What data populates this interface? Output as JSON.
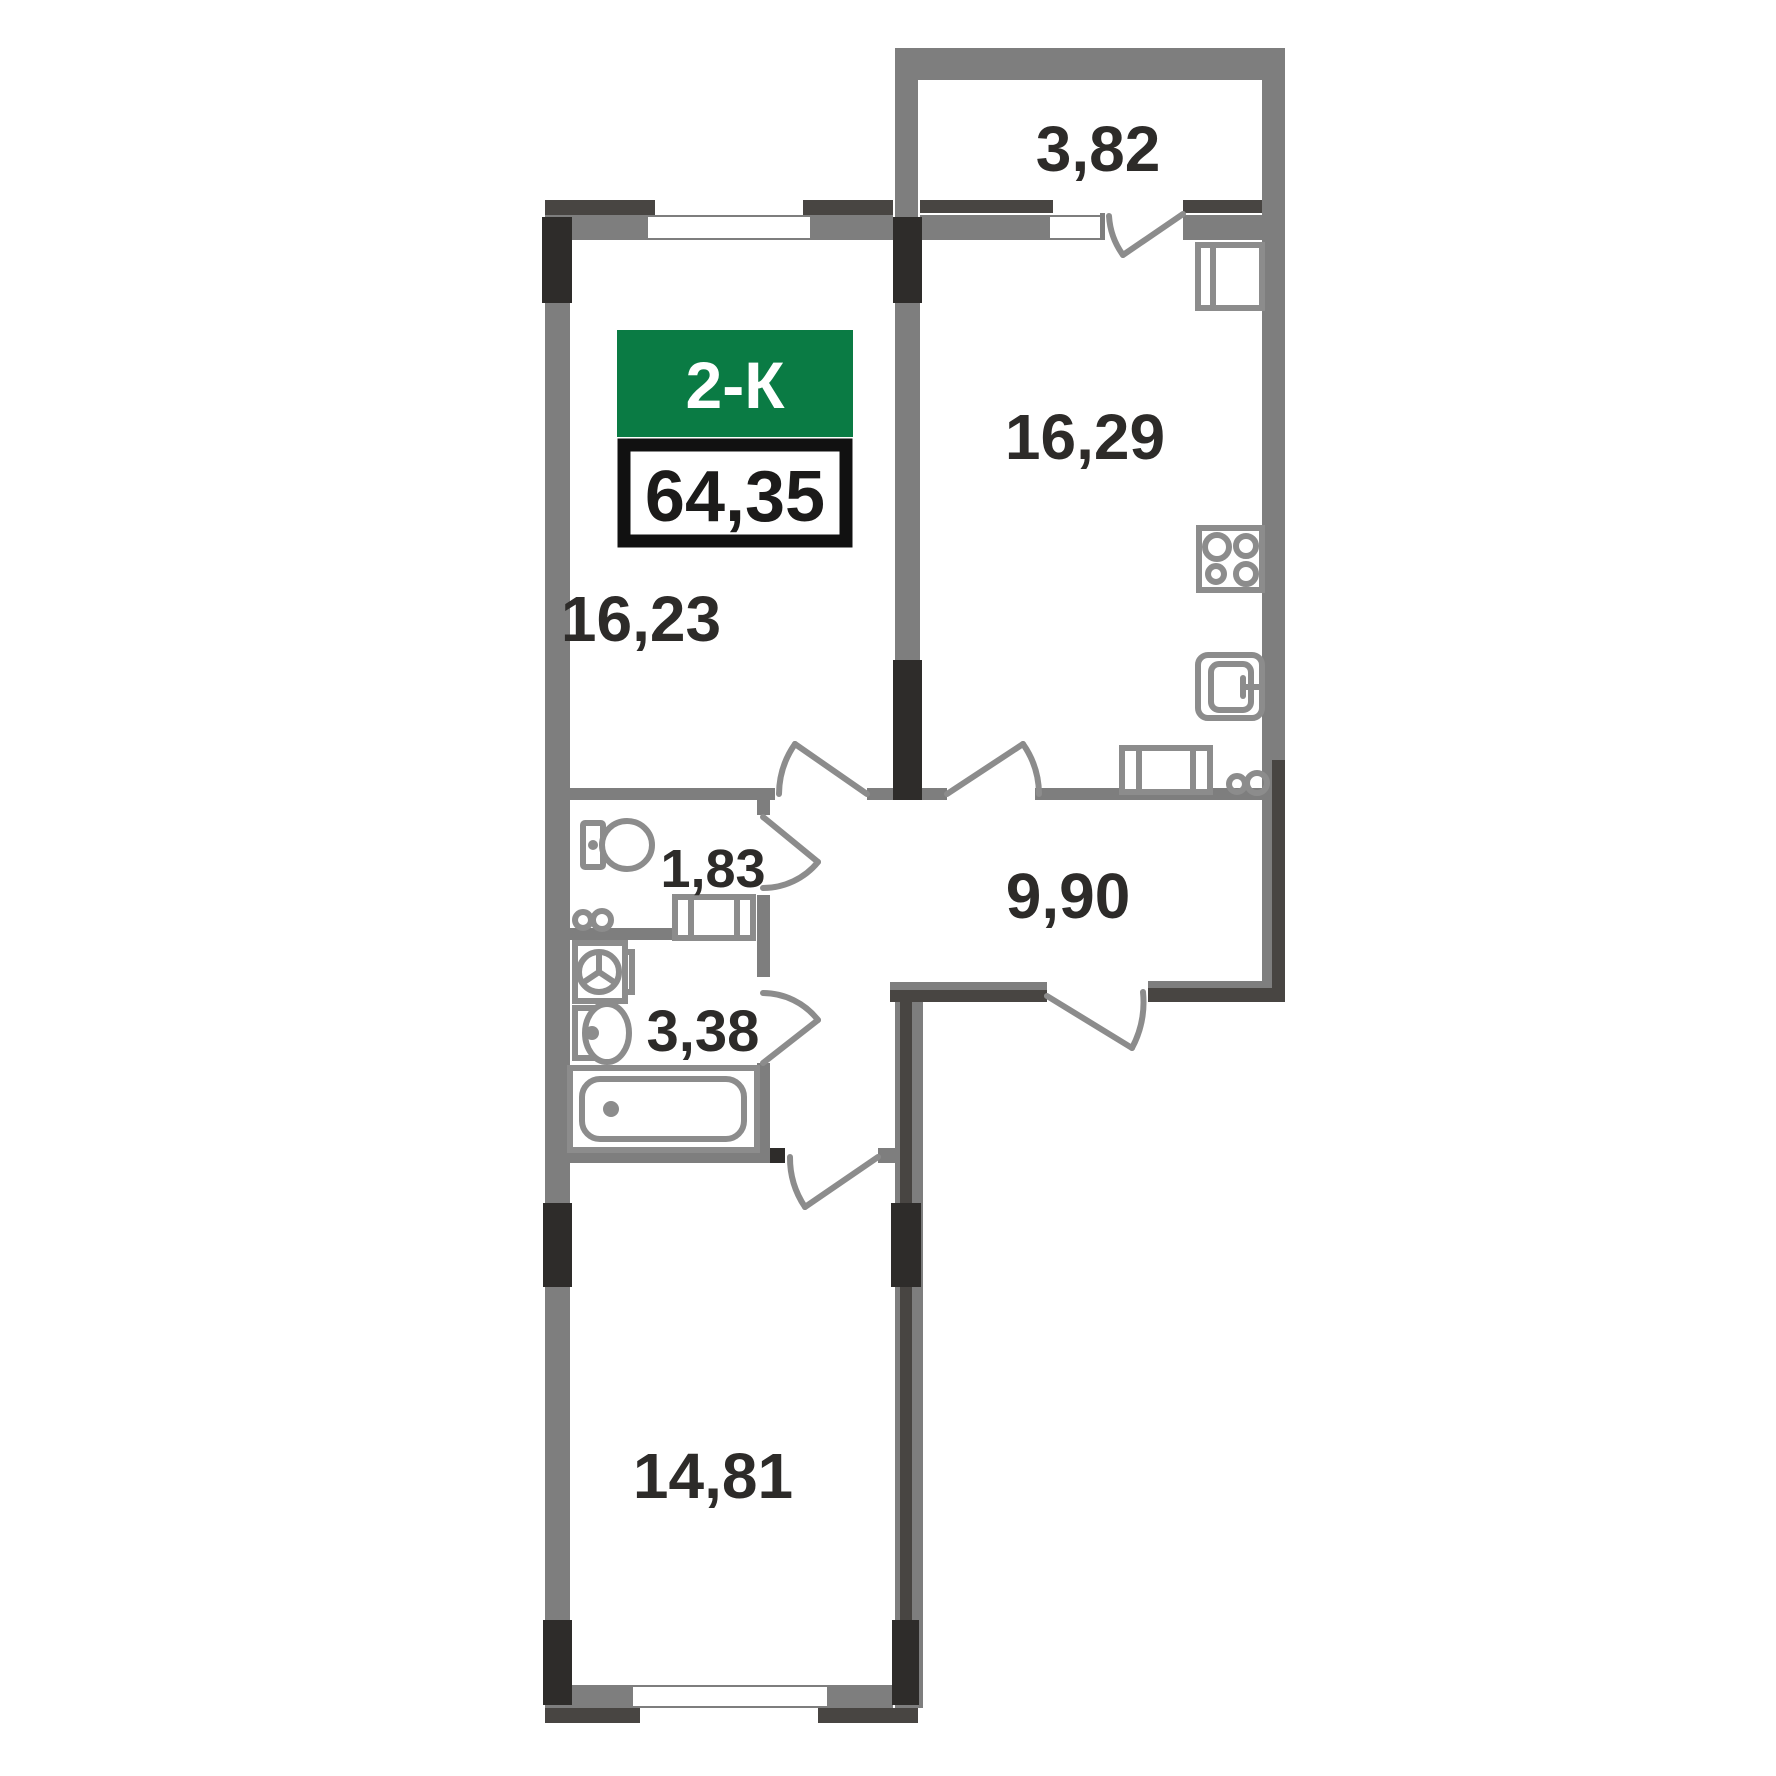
{
  "badge": {
    "type_label": "2-К",
    "total_area_label": "64,35"
  },
  "rooms": {
    "balcony": "3,82",
    "kitchen": "16,29",
    "living_room": "16,23",
    "wc": "1,83",
    "hallway": "9,90",
    "bathroom": "3,38",
    "bedroom": "14,81"
  },
  "icons": [
    "toilet-icon",
    "washing-machine-icon",
    "bath-sink-icon",
    "bathtub-icon",
    "fridge-icon",
    "stove-icon",
    "kitchen-sink-icon",
    "vent-duct-icon",
    "pipe-riser-icon",
    "door-swing-icon",
    "window-icon"
  ],
  "colors": {
    "wall_gray": "#7e7e7e",
    "wall_dark": "#484542",
    "pillar_black": "#2e2c2a",
    "accent_green": "#0a7b44",
    "badge_border": "#111111",
    "text_dark": "#2d2b29",
    "fixture_gray": "#8c8c8c"
  }
}
